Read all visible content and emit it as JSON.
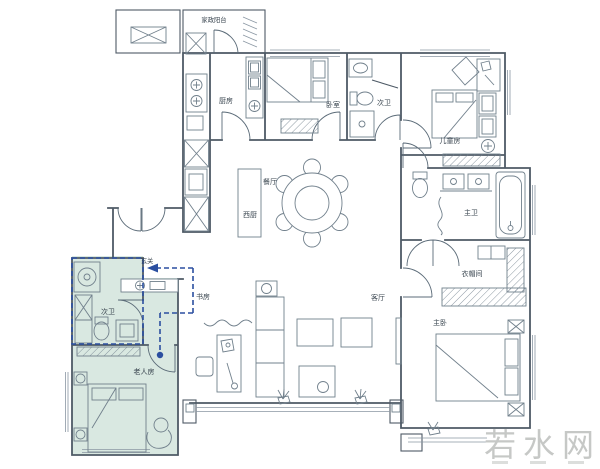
{
  "floorplan": {
    "rooms": {
      "service_balcony": "家政阳台",
      "kitchen": "厨房",
      "bedroom": "卧室",
      "bath_top": "次卫",
      "kids_room": "儿童房",
      "dining": "餐厅",
      "west_kitchen": "西厨",
      "master_bath": "主卫",
      "entry": "玄关",
      "study": "书房",
      "bath_left": "次卫",
      "living": "客厅",
      "cloakroom": "衣帽间",
      "master_bedroom": "主卧",
      "elder_room": "老人房"
    },
    "colors": {
      "wall": "#4e5a66",
      "furniture": "#71808c",
      "highlight_fill": "#d9e8e1",
      "annotation_blue": "#2b4fa0",
      "label": "#39454f",
      "watermark": "#c6c8c6"
    }
  },
  "watermark": {
    "text": "若水网"
  }
}
